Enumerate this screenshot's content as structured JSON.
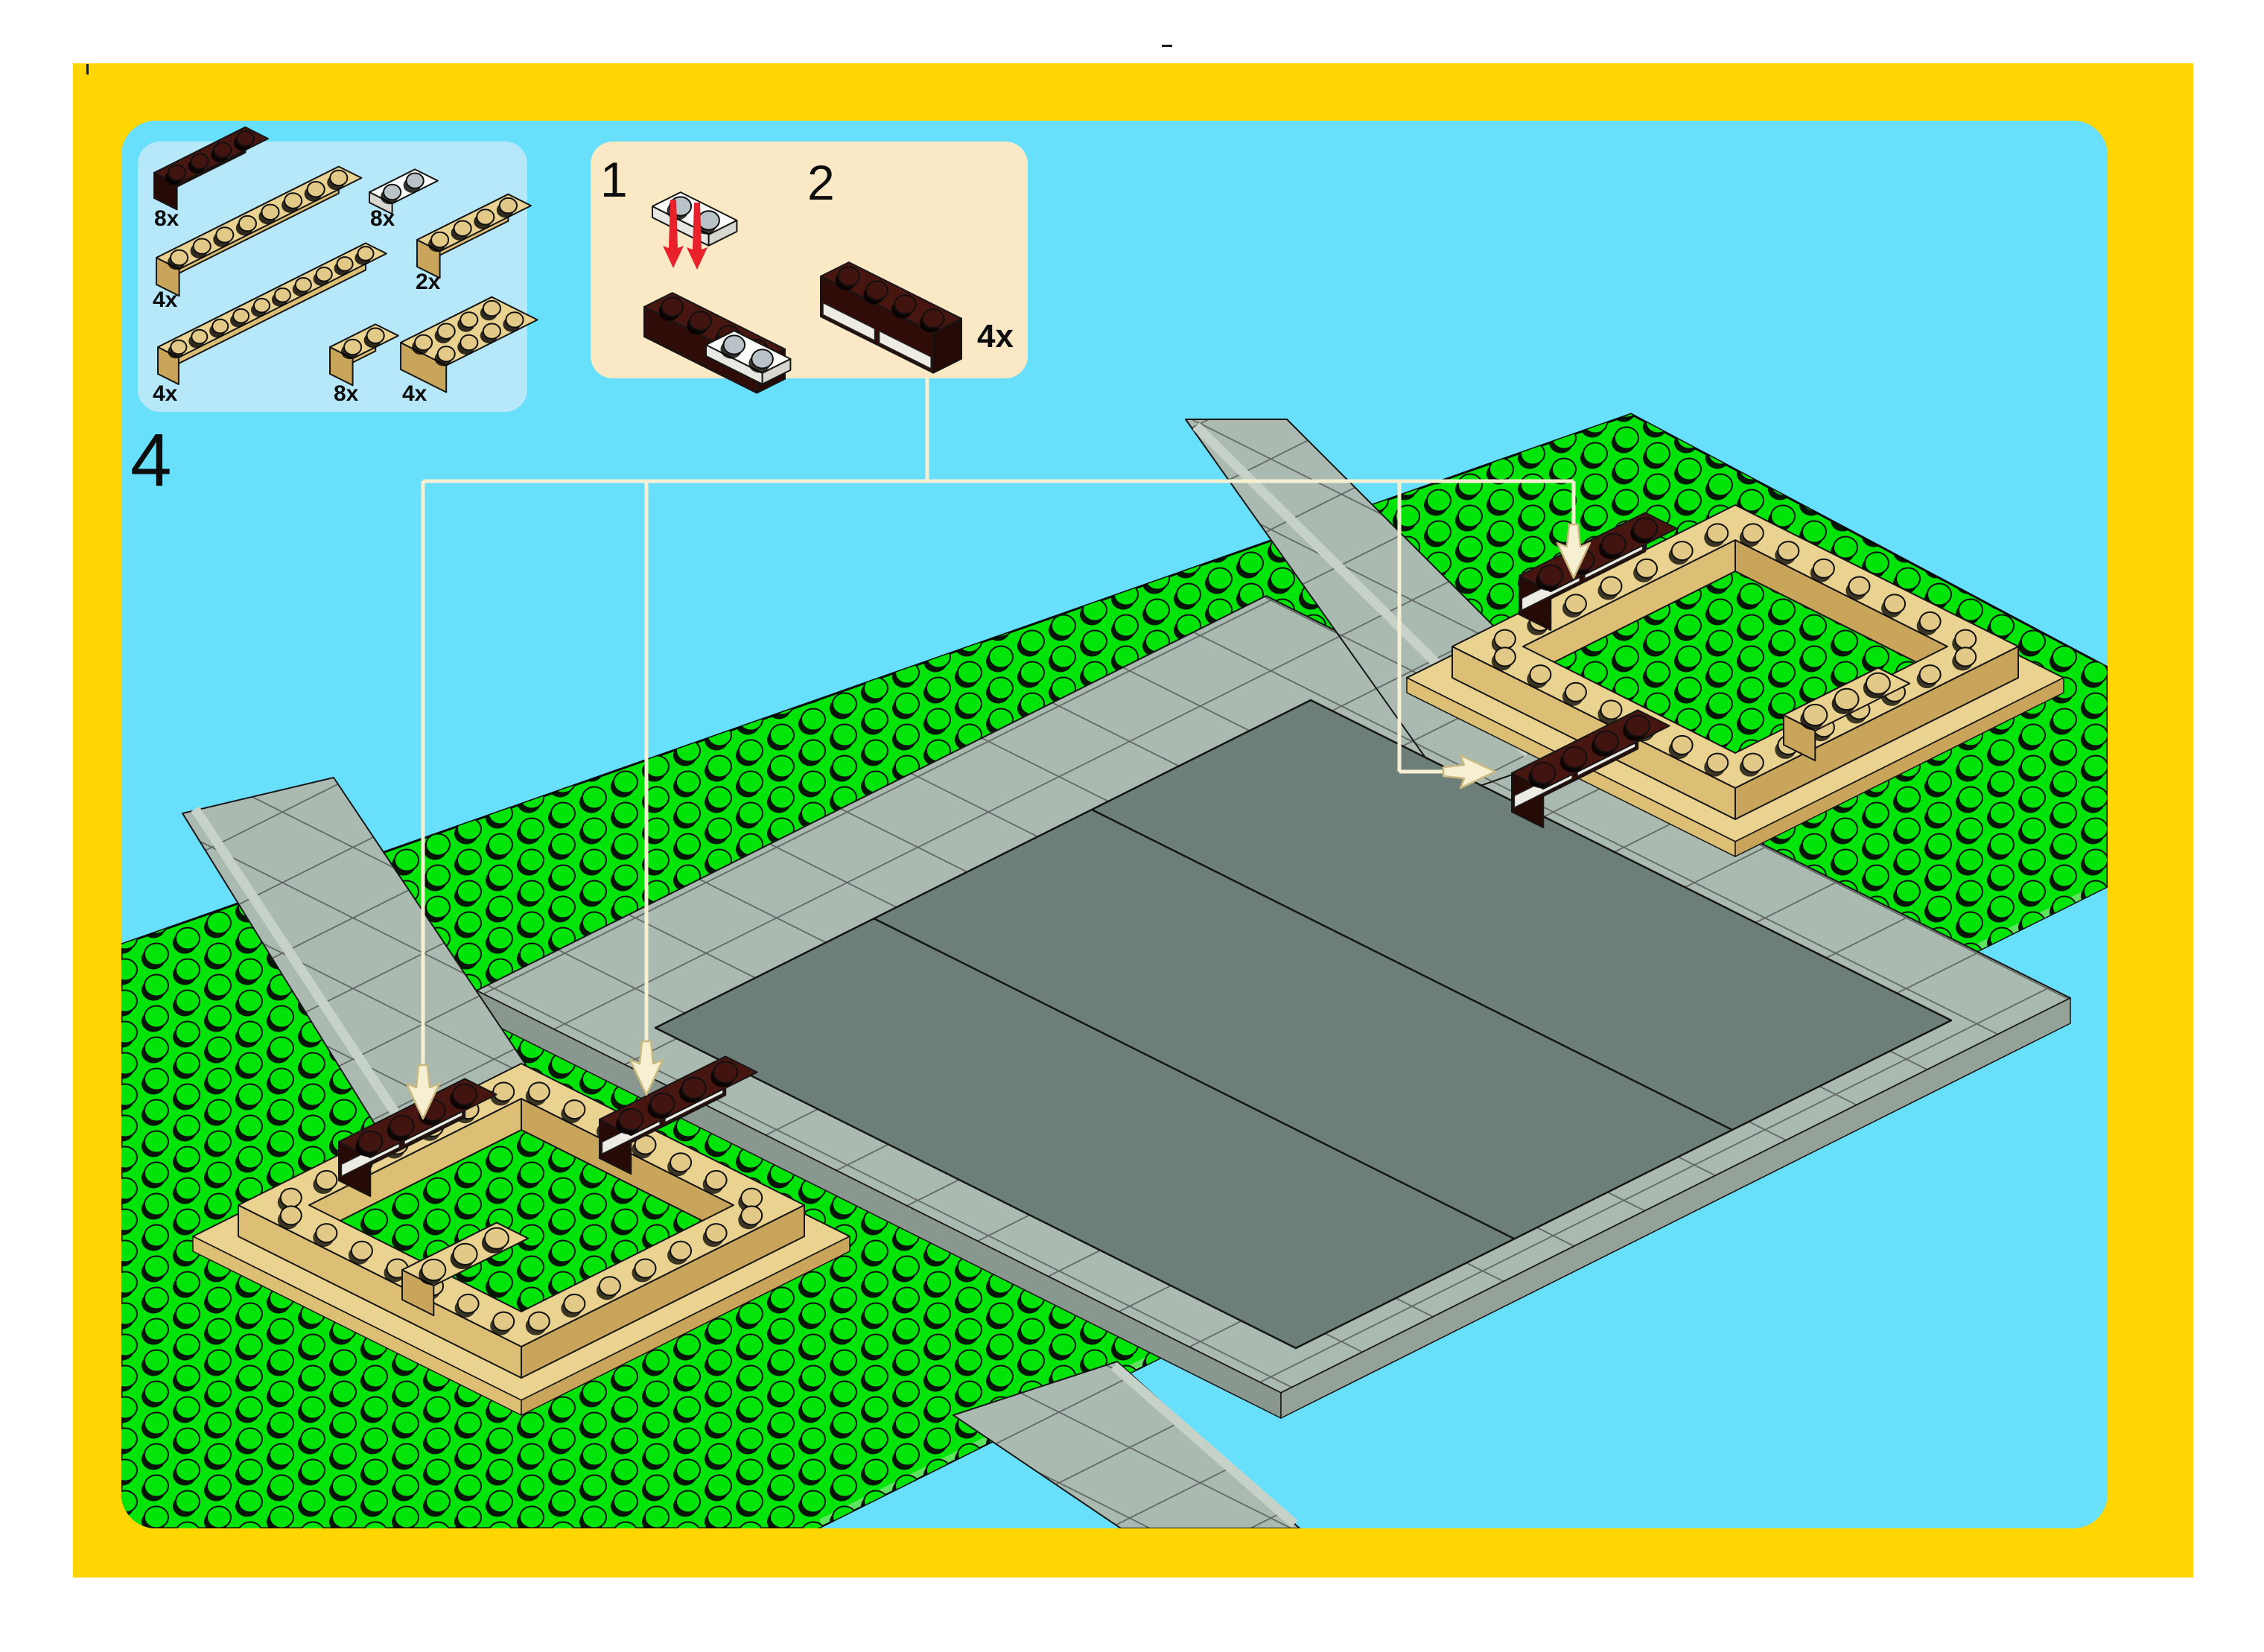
{
  "page": {
    "step_number": "4"
  },
  "parts": {
    "items": [
      {
        "name": "brick-1x4-dark-brown",
        "qty": "8x"
      },
      {
        "name": "plate-1x2-white",
        "qty": "8x"
      },
      {
        "name": "brick-1x8-tan",
        "qty": "4x"
      },
      {
        "name": "brick-1x4-tan",
        "qty": "2x"
      },
      {
        "name": "brick-1x10-tan",
        "qty": "4x"
      },
      {
        "name": "brick-1x2-tan",
        "qty": "8x"
      },
      {
        "name": "brick-2x4-tan",
        "qty": "4x"
      }
    ]
  },
  "substeps": {
    "steps": [
      {
        "label": "1"
      },
      {
        "label": "2"
      }
    ],
    "assembly_count": "4x",
    "assembly_name": "brick-1x4-dark-brown-with-two-white-1x2-plates"
  },
  "colors": {
    "frame_yellow": "#FFD502",
    "sky": "#68DFFB",
    "parts_panel_blue": "#B7E8FA",
    "substep_panel_cream": "#FAE9C4",
    "grass_green": "#00E40A",
    "sidewalk_gray": "#ABBAB1",
    "plaza_gray": "#6E7F79",
    "tan_brick": "#EAD291",
    "dark_brown_brick": "#471610",
    "callout_cream": "#F6EFD2",
    "red_arrow": "#E8212B"
  }
}
